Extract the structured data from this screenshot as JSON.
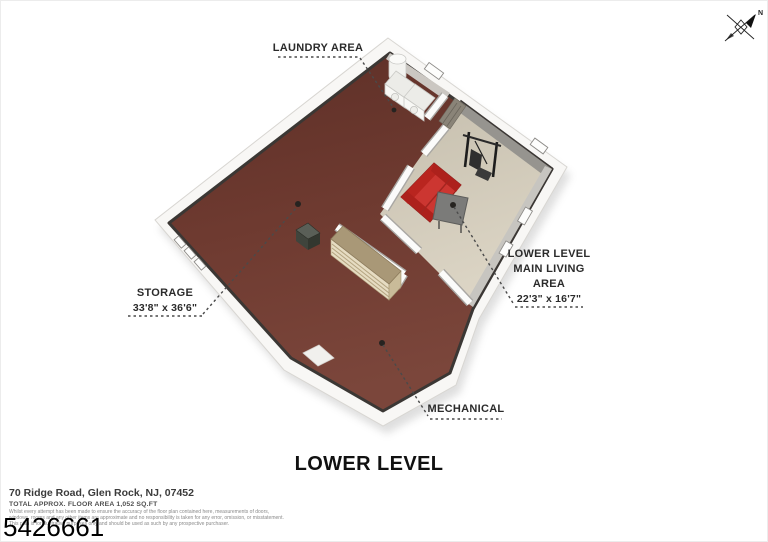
{
  "title": "LOWER LEVEL",
  "plan_labels": {
    "laundry": "LAUNDRY AREA",
    "storage": "STORAGE",
    "storage_dims": "33'8\" x 36'6\"",
    "living_1": "LOWER LEVEL",
    "living_2": "MAIN LIVING",
    "living_3": "AREA",
    "living_dims": "22'3\" x 16'7\"",
    "mechanical": "MECHANICAL"
  },
  "compass": {
    "north": "N"
  },
  "footer": {
    "address": "70 Ridge Road, Glen Rock, NJ, 07452",
    "floor_area": "TOTAL APPROX. FLOOR AREA 1,052 SQ.FT",
    "disclaimer_1": "Whilst every attempt has been made to ensure the accuracy of the floor plan contained here, measurements of doors,",
    "disclaimer_2": "windows, rooms and any other items are approximate and no responsibility is taken for any error, omission, or misstatement.",
    "disclaimer_3": "This plan is for illustrative purposes only and should be used as such by any prospective purchaser.",
    "listing_id": "5426661"
  },
  "colors": {
    "storage_floor": "#6e3a30",
    "living_floor": "#d7d0c0",
    "exterior_wall": "#f8f7f5",
    "wall_top_line": "#3b3734",
    "sofa_red": "#c62f2c",
    "shelf_tan": "#a99877",
    "table_gray": "#7b7b79"
  }
}
